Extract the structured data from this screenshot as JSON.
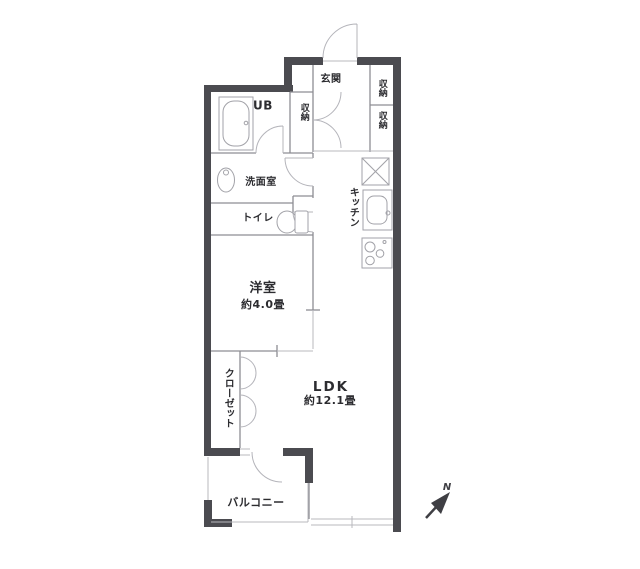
{
  "floorplan": {
    "rooms": {
      "entrance": {
        "label": "玄関"
      },
      "hall_storage": {
        "label": "収納"
      },
      "storage_upper": {
        "label": "収納"
      },
      "storage_lower": {
        "label": "収納"
      },
      "unit_bath": {
        "label": "UB"
      },
      "washroom": {
        "label": "洗面室"
      },
      "toilet": {
        "label": "トイレ"
      },
      "kitchen": {
        "label": "キッチン"
      },
      "western_room": {
        "label": "洋室",
        "size": "約4.0畳"
      },
      "closet": {
        "label": "クローゼット"
      },
      "ldk": {
        "label": "LDK",
        "size": "約12.1畳"
      },
      "balcony": {
        "label": "バルコニー"
      }
    },
    "compass": {
      "label": "N"
    },
    "colors": {
      "wall": "#4b4b50",
      "interior_line": "#8d8d93",
      "light_line": "#b8b8be",
      "fixture_line": "#a2a2a8",
      "text": "#2c2c30",
      "background": "#ffffff"
    }
  }
}
